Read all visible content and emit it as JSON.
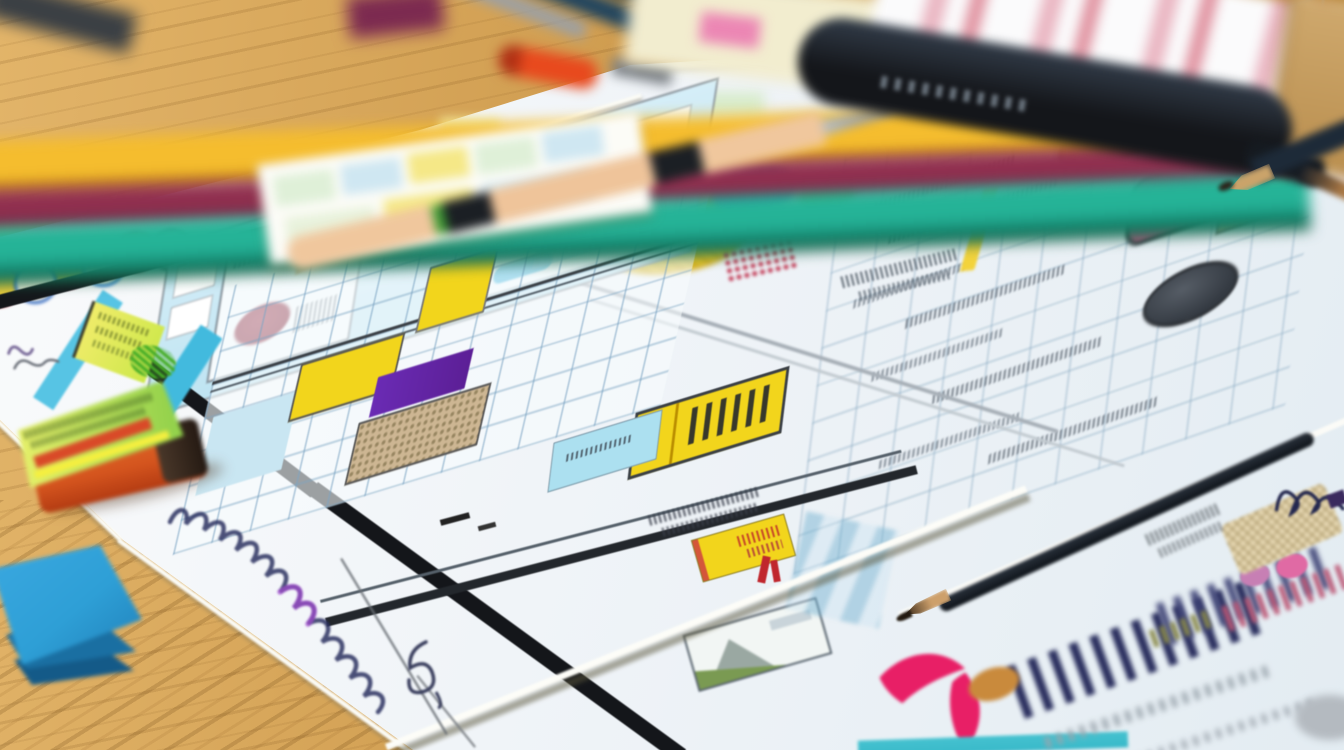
{
  "scene": {
    "type": "photograph",
    "caption": "Close-up photo of hand-drawn UI wireframe sketches on overlapping paper sheets spread across a golden oak desk. Blurred colored pencils and pens lie along the top, a black marker rests on a pink-striped sheet, the main sketch shows a cyan header panel, blue grids with yellow and purple highlighted cells, scribbled pseudo-text, sketched colored ovals, a yellow scribbled circle, an orange eraser, blue sticky notes, cursive ink handwriting, a pink Y-shaped logo and blurred navy lettering on the bottom sheet."
  },
  "objects": {
    "desk": {
      "label": "Wooden desk surface"
    },
    "colored_pencils": {
      "label": "Colored pencils: yellow, maroon, teal"
    },
    "pen_cluster": {
      "label": "Cluster of pens and pencils"
    },
    "grid_notepad": {
      "label": "Small notepad card with pastel grid cells"
    },
    "segmented_pen": {
      "label": "Beige segmented pen with black bands"
    },
    "cream_notepad": {
      "label": "Cream notepad with pink tab"
    },
    "striped_paper": {
      "label": "White sheet with pink stripes"
    },
    "tan_folder": {
      "label": "Tan folder"
    },
    "black_marker": {
      "label": "Large black marker"
    },
    "wireframe_sheet": {
      "label": "Main wireframe sketch sheet with cyan panel and grids"
    },
    "right_sheet": {
      "label": "Sketch sheet with three colored oval drawings"
    },
    "overlay_sheet": {
      "label": "Sheet with yellow scribbled circle and colored blobs"
    },
    "bottom_sheet": {
      "label": "Bottom sheet with pink Y logo and blurred navy text"
    },
    "handwriting_sheet": {
      "label": "Sheet edge with cursive ink handwriting"
    },
    "eraser": {
      "label": "Orange eraser with printed green sleeve"
    },
    "sticky_notes": {
      "label": "Stack of blue sticky notes"
    },
    "graphite_pencil": {
      "label": "Sharpened graphite pencil"
    }
  },
  "palette": {
    "wood_light": "#e2b469",
    "wood_mid": "#cf9c4f",
    "pencil_yellow": "#f0b42a",
    "pencil_maroon": "#8e2f4f",
    "pencil_teal": "#1fae92",
    "pencil_green": "#175c3f",
    "pencil_navy": "#20445e",
    "pen_orange": "#e8491d",
    "pen_beige": "#f0c79d",
    "ink_black": "#14161a",
    "notepad_cream": "#f2edcf",
    "tab_pink": "#ec86b4",
    "paper_white": "#f7f9fb",
    "stripe_pink": "#e0919f",
    "panel_cyan": "#bfe4f2",
    "strip_cyan": "#42bade",
    "highlight_yellow": "#f2d51c",
    "cell_purple": "#5c1f96",
    "blob_red": "#7e2236",
    "scribble_magenta": "#b8385e",
    "sticky_lime": "#cde84a",
    "scribble_green": "#46ad27",
    "eraser_orange": "#d4541e",
    "label_green": "#8fd04a",
    "sticky_blue": "#2e9fd6",
    "logo_pink": "#e81f66",
    "ink_navy": "#2c3160",
    "ink_purple": "#a24ad0",
    "grid_blue": "#8fb8d0",
    "tan_cell": "#cdb693",
    "oval_brown": "#c49a94",
    "oval_pink": "#c45b84",
    "oval_dark": "#343a42",
    "blob_blue": "#2f7fd6",
    "blob_green": "#7fc14c",
    "teal_strip": "#39b9c9"
  }
}
